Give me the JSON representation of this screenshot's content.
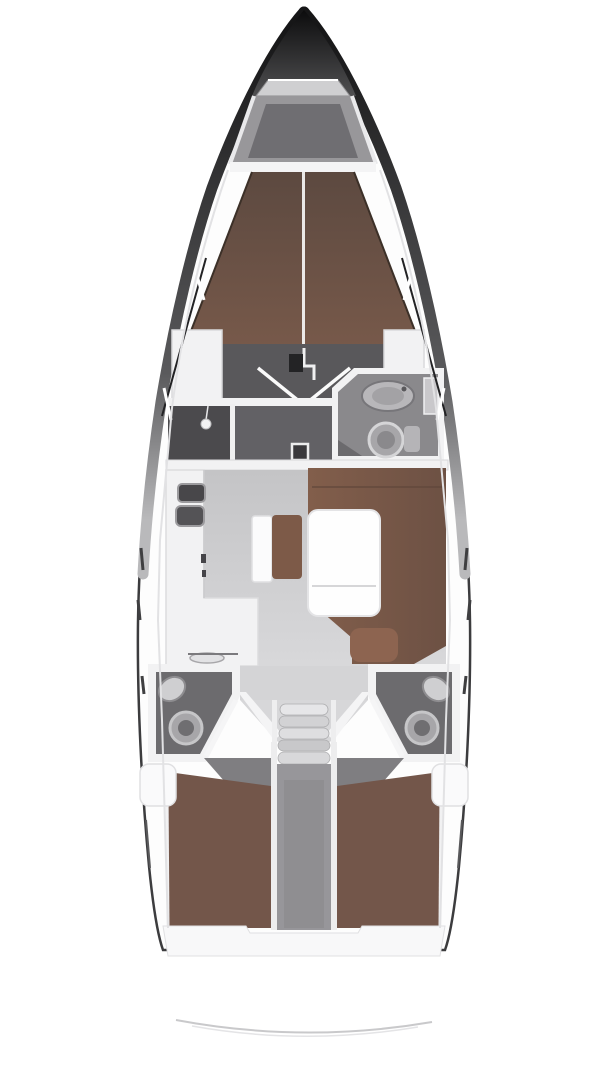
{
  "diagram": {
    "kind": "sailboat-interior-floorplan",
    "view": "top-down",
    "regions": [
      "bow-anchor-locker",
      "foredeck-frame",
      "v-berth",
      "forward-cabin",
      "shower-compartment",
      "forward-head",
      "main-bulkhead",
      "galley",
      "salon",
      "salon-table",
      "salon-bench",
      "u-settee",
      "companionway-steps",
      "aft-head-port",
      "aft-head-starboard",
      "aft-cabin-port",
      "aft-cabin-starboard",
      "engine-compartment",
      "transom",
      "swim-platform"
    ],
    "fixtures": [
      "sink",
      "toilet",
      "shower-head",
      "stove",
      "mast-post",
      "door-swing",
      "stay-line",
      "hull-window",
      "stanchion"
    ]
  },
  "colors": {
    "background": "#ffffff",
    "hull_outline": "#3c3c3e",
    "bow_dark": "#121213",
    "deck_band": "#f4f4f5",
    "frame_gray": "#98979a",
    "frame_inner": "#6f6e72",
    "hatch_gray": "#cfcfd1",
    "berth_forward": "#6e5447",
    "berth_aft": "#73564a",
    "settee_brown": "#7b5847",
    "cushion_accent": "#8d6450",
    "bench_cushion": "#7d5a48",
    "floor_cabin_dark": "#59585b",
    "floor_vestibule": "#626165",
    "shower_dark": "#4b4a4d",
    "floor_head_fwd": "#8a898c",
    "floor_head_aft": "#6c6b6e",
    "floor_salon": "#c9c9cb",
    "corridor_light": "#d4d4d6",
    "entrance_gray": "#7f7e81",
    "engine_gray": "#97969a",
    "wall_white": "#f2f2f3",
    "table_white": "#fefefe",
    "fixture_light": "#cfcfd1",
    "fixture_mid": "#a7a6a9",
    "transom_white": "#f8f8f9",
    "platform_line": "#c9c9cb"
  }
}
